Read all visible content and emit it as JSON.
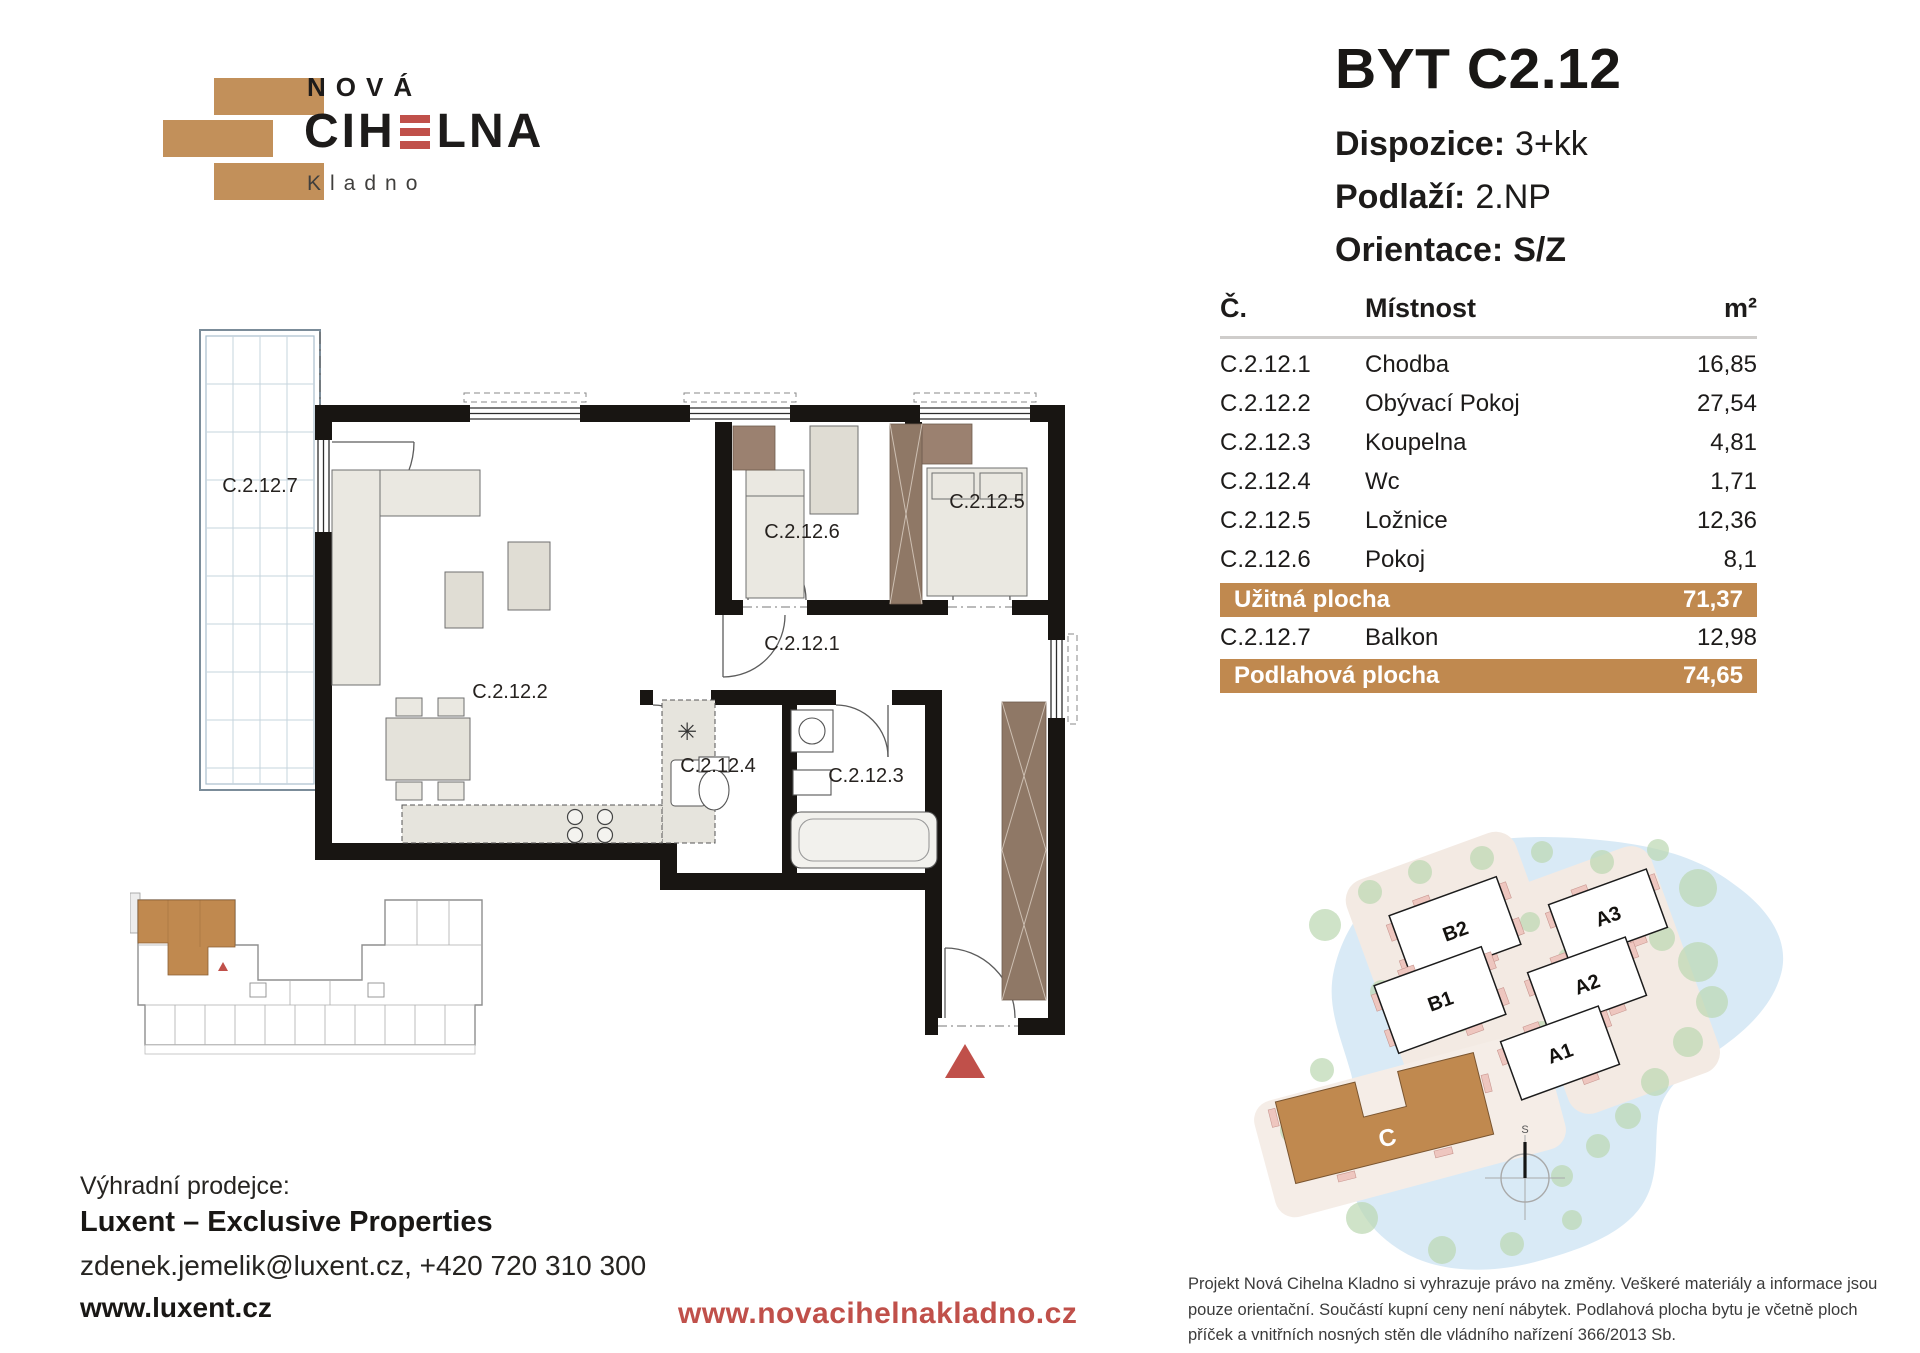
{
  "logo": {
    "top": "NOVÁ",
    "main_pre": "CIH",
    "main_post": "LNA",
    "sub": "Kladno"
  },
  "header": {
    "title": "BYT C2.12",
    "specs": [
      {
        "label": "Dispozice:",
        "value": "3+kk"
      },
      {
        "label": "Podlaží:",
        "value": "2.NP"
      },
      {
        "label": "Orientace:",
        "value": "S/Z"
      }
    ]
  },
  "table": {
    "col_num": "Č.",
    "col_room": "Místnost",
    "col_area": "m²",
    "rows": [
      {
        "num": "C.2.12.1",
        "room": "Chodba",
        "area": "16,85"
      },
      {
        "num": "C.2.12.2",
        "room": "Obývací Pokoj",
        "area": "27,54"
      },
      {
        "num": "C.2.12.3",
        "room": "Koupelna",
        "area": "4,81"
      },
      {
        "num": "C.2.12.4",
        "room": "Wc",
        "area": "1,71"
      },
      {
        "num": "C.2.12.5",
        "room": "Ložnice",
        "area": "12,36"
      },
      {
        "num": "C.2.12.6",
        "room": "Pokoj",
        "area": "8,1"
      }
    ],
    "usable": {
      "label": "Užitná plocha",
      "value": "71,37"
    },
    "balcony_row": {
      "num": "C.2.12.7",
      "room": "Balkon",
      "area": "12,98"
    },
    "floor_total": {
      "label": "Podlahová plocha",
      "value": "74,65"
    }
  },
  "floorplan": {
    "labels": {
      "balcony": "C.2.12.7",
      "living": "C.2.12.2",
      "hall": "C.2.12.1",
      "room": "C.2.12.6",
      "bedroom": "C.2.12.5",
      "wc": "C.2.12.4",
      "bath": "C.2.12.3"
    }
  },
  "siteplan": {
    "b2": "B2",
    "b1": "B1",
    "a3": "A3",
    "a2": "A2",
    "a1": "A1",
    "c": "C",
    "compass": "S"
  },
  "footer": {
    "seller_label": "Výhradní prodejce:",
    "seller_name": "Luxent – Exclusive Properties",
    "seller_contact": "zdenek.jemelik@luxent.cz, +420 720 310 300",
    "seller_web": "www.luxent.cz",
    "project_web": "www.novacihelnakladno.cz",
    "disclaimer": "Projekt Nová Cihelna Kladno si vyhrazuje právo na změny. Veškeré materiály a informace jsou pouze orientační. Součástí kupní ceny není nábytek. Podlahová plocha bytu je včetně ploch příček a vnitřních nosných stěn dle vládního nařízení 366/2013 Sb."
  },
  "colors": {
    "brick": "#C0894F",
    "red": "#C0504A",
    "text": "#1D1B1A"
  }
}
